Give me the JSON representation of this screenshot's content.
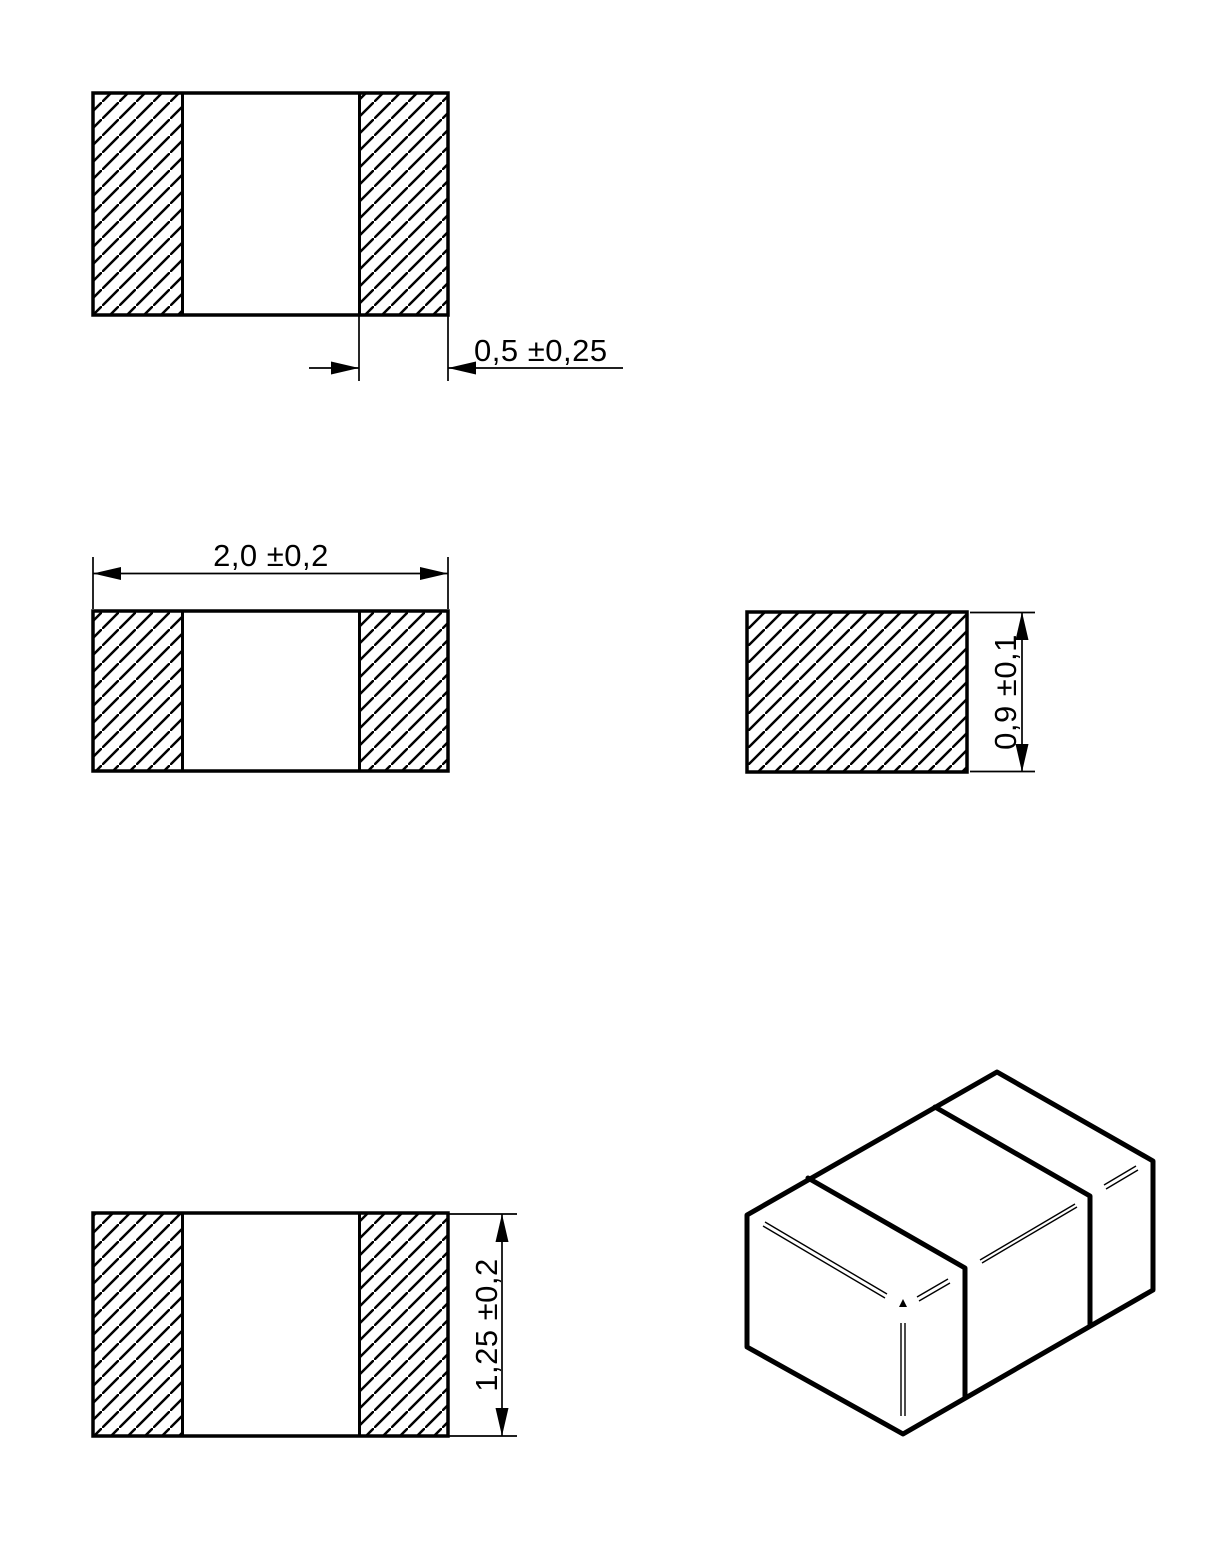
{
  "drawing": {
    "background": "#ffffff",
    "line_color": "#000000",
    "dim_terminal_width": "0,5 ±0,25",
    "dim_length": "2,0 ±0,2",
    "dim_height": "0,9 ±0,1",
    "dim_width": "1,25 ±0,2"
  }
}
